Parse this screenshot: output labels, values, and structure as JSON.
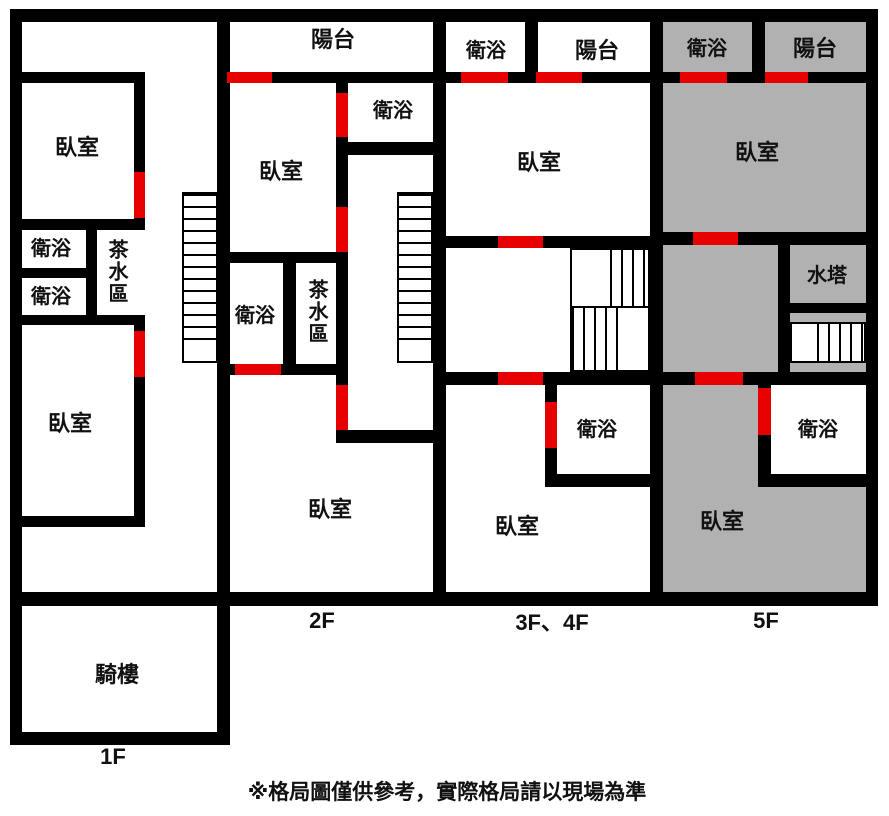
{
  "colors": {
    "wall": "#000000",
    "door": "#e60000",
    "fill": "#b1b1b1",
    "text": "#111111",
    "bg": "#ffffff"
  },
  "disclaimer": "※格局圖僅供參考，實際格局請以現場為準",
  "floor_1f": {
    "label": "1F",
    "bedroom_upper": "臥室",
    "bath_1": "衛浴",
    "bath_2": "衛浴",
    "tea_area": "茶水區",
    "bedroom_lower": "臥室",
    "arcade": "騎樓"
  },
  "floor_2f": {
    "label": "2F",
    "balcony": "陽台",
    "bath_upper": "衛浴",
    "bedroom_upper": "臥室",
    "bath_lower": "衛浴",
    "tea_area": "茶水區",
    "bedroom_lower": "臥室"
  },
  "floor_3f4f": {
    "label": "3F、4F",
    "bath_top": "衛浴",
    "balcony": "陽台",
    "bedroom_upper": "臥室",
    "bath_mid": "衛浴",
    "bedroom_lower": "臥室"
  },
  "floor_5f": {
    "label": "5F",
    "bath_top": "衛浴",
    "balcony": "陽台",
    "bedroom_upper": "臥室",
    "water_tower": "水塔",
    "bath_mid": "衛浴",
    "bedroom_lower": "臥室"
  }
}
